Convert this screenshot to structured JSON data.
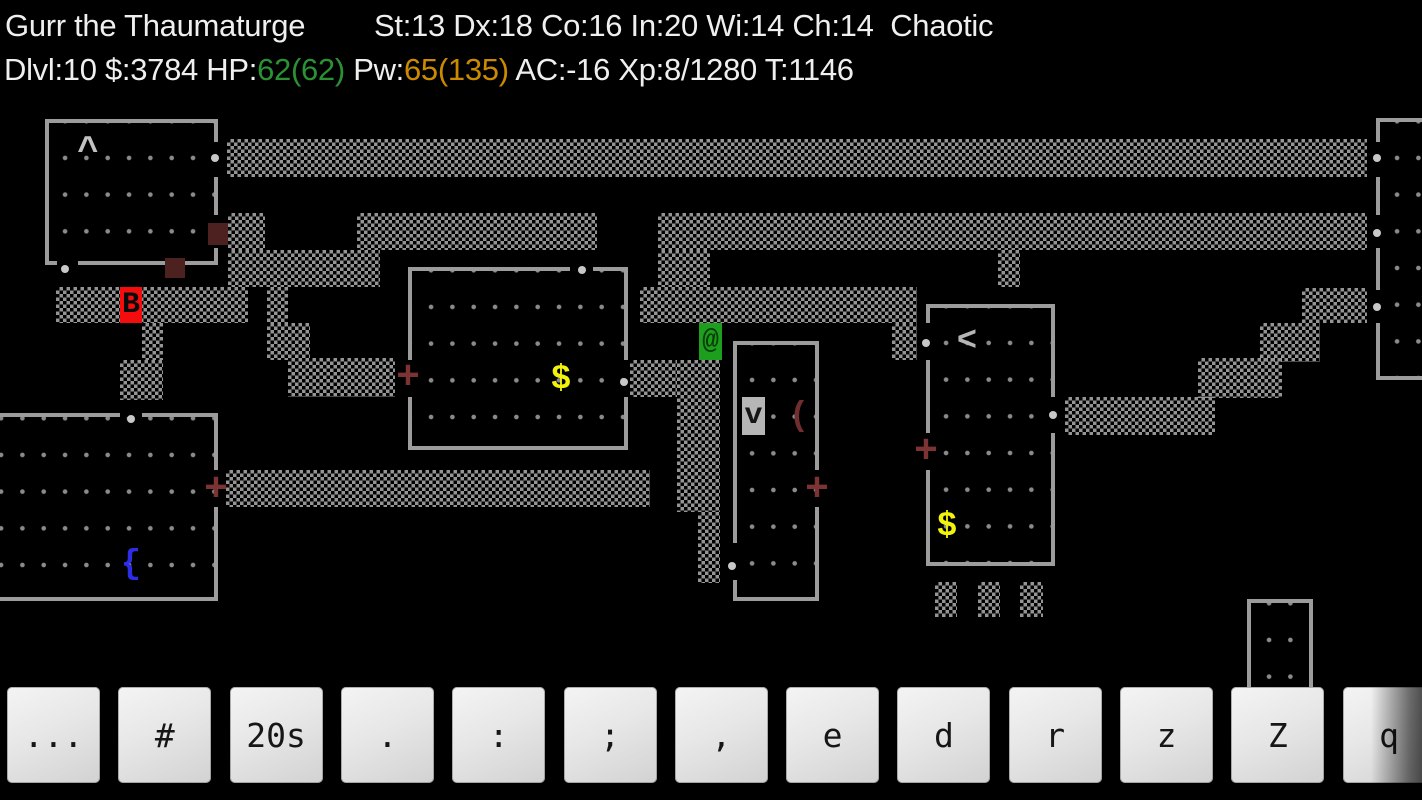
{
  "status": {
    "line1_left": "Gurr the Thaumaturge",
    "line1_right": "St:13 Dx:18 Co:16 In:20 Wi:14 Ch:14  Chaotic",
    "line2": [
      {
        "text": "Dlvl:10 $:3784 HP:",
        "color": "#efefef"
      },
      {
        "text": "62(62)",
        "color": "#2a9235"
      },
      {
        "text": " Pw:",
        "color": "#efefef"
      },
      {
        "text": "65(135)",
        "color": "#cc8a00"
      },
      {
        "text": " AC:-16 Xp:8/1280 T:1146",
        "color": "#efefef"
      }
    ]
  },
  "palette": {
    "wall": "#9c9c9c",
    "floor_dot": "#8b8b8b",
    "corridor_dot": "#949494",
    "doorway_dot": "#c8c8c8",
    "closed_door": "#4e2121"
  },
  "map": {
    "walls": [
      [
        45,
        119,
        173,
        4
      ],
      [
        45,
        119,
        4,
        146
      ],
      [
        214,
        119,
        4,
        23
      ],
      [
        214,
        177,
        4,
        38
      ],
      [
        214,
        248,
        4,
        17
      ],
      [
        45,
        261,
        12,
        4
      ],
      [
        78,
        261,
        87,
        4
      ],
      [
        184,
        261,
        34,
        4
      ],
      [
        408,
        267,
        162,
        4
      ],
      [
        593,
        267,
        35,
        4
      ],
      [
        408,
        267,
        4,
        93
      ],
      [
        408,
        397,
        4,
        53
      ],
      [
        624,
        267,
        4,
        93
      ],
      [
        624,
        397,
        4,
        53
      ],
      [
        408,
        446,
        220,
        4
      ],
      [
        733,
        341,
        86,
        4
      ],
      [
        733,
        341,
        4,
        202
      ],
      [
        733,
        580,
        4,
        21
      ],
      [
        815,
        341,
        4,
        129
      ],
      [
        815,
        507,
        4,
        94
      ],
      [
        733,
        597,
        86,
        4
      ],
      [
        926,
        304,
        129,
        4
      ],
      [
        926,
        304,
        4,
        19
      ],
      [
        926,
        360,
        4,
        73
      ],
      [
        926,
        470,
        4,
        96
      ],
      [
        1051,
        304,
        4,
        93
      ],
      [
        1051,
        433,
        4,
        133
      ],
      [
        926,
        562,
        129,
        4
      ],
      [
        0,
        413,
        120,
        4
      ],
      [
        142,
        413,
        76,
        4
      ],
      [
        214,
        413,
        4,
        57
      ],
      [
        214,
        507,
        4,
        94
      ],
      [
        0,
        597,
        218,
        4
      ],
      [
        1247,
        599,
        66,
        4
      ],
      [
        1247,
        599,
        4,
        99
      ],
      [
        1309,
        599,
        4,
        99
      ],
      [
        1376,
        118,
        46,
        4
      ],
      [
        1376,
        118,
        4,
        24
      ],
      [
        1376,
        177,
        4,
        38
      ],
      [
        1376,
        248,
        4,
        42
      ],
      [
        1376,
        323,
        4,
        57
      ],
      [
        1376,
        376,
        46,
        4
      ]
    ],
    "floors": [
      {
        "rect": [
          49,
          123,
          165,
          138
        ],
        "dot": [
          5.4,
          16.6
        ]
      },
      {
        "rect": [
          412,
          271,
          212,
          175
        ],
        "dot": [
          8.4,
          17.6
        ]
      },
      {
        "rect": [
          737,
          345,
          78,
          252
        ],
        "dot": [
          4.4,
          16.6
        ]
      },
      {
        "rect": [
          930,
          308,
          121,
          254
        ],
        "dot": [
          5.4,
          16.6
        ]
      },
      {
        "rect": [
          0,
          417,
          214,
          180
        ],
        "dot": [
          -9.6,
          19.6
        ]
      },
      {
        "rect": [
          1251,
          603,
          58,
          96
        ],
        "dot": [
          7.4,
          18.6
        ]
      },
      {
        "rect": [
          1380,
          122,
          42,
          254
        ],
        "dot": [
          6.4,
          17.6
        ]
      }
    ],
    "corridors": [
      [
        227,
        139,
        1140,
        38
      ],
      [
        228,
        213,
        37,
        37
      ],
      [
        228,
        250,
        152,
        37
      ],
      [
        357,
        213,
        240,
        37
      ],
      [
        658,
        213,
        709,
        37
      ],
      [
        658,
        250,
        52,
        37
      ],
      [
        998,
        250,
        22,
        37
      ],
      [
        56,
        287,
        192,
        36
      ],
      [
        142,
        323,
        21,
        37
      ],
      [
        120,
        360,
        43,
        40
      ],
      [
        267,
        287,
        21,
        36
      ],
      [
        267,
        323,
        43,
        37
      ],
      [
        288,
        358,
        107,
        39
      ],
      [
        640,
        287,
        277,
        36
      ],
      [
        892,
        323,
        25,
        37
      ],
      [
        630,
        360,
        47,
        37
      ],
      [
        677,
        360,
        43,
        152
      ],
      [
        698,
        512,
        22,
        71
      ],
      [
        226,
        470,
        424,
        37
      ],
      [
        1065,
        397,
        150,
        38
      ],
      [
        1198,
        358,
        84,
        40
      ],
      [
        1260,
        323,
        60,
        39
      ],
      [
        1302,
        288,
        65,
        35
      ],
      [
        935,
        582,
        22,
        35
      ],
      [
        978,
        582,
        22,
        35
      ],
      [
        1020,
        582,
        23,
        35
      ]
    ],
    "closed_doors": [
      [
        208,
        223,
        20,
        22
      ],
      [
        165,
        258,
        20,
        20
      ]
    ],
    "doorway_dots": [
      [
        215,
        158
      ],
      [
        65,
        269
      ],
      [
        582,
        270
      ],
      [
        624,
        382
      ],
      [
        732,
        566
      ],
      [
        131,
        419
      ],
      [
        926,
        343
      ],
      [
        1053,
        415
      ],
      [
        1377,
        158
      ],
      [
        1377,
        233
      ],
      [
        1377,
        307
      ]
    ],
    "glyphs": [
      {
        "name": "trap",
        "ch": "^",
        "box": [
          77,
          134,
          22,
          34
        ],
        "fg": "#c2c2c2",
        "size": 36,
        "inter": false
      },
      {
        "name": "stairs-up",
        "ch": "<",
        "box": [
          956,
          323,
          22,
          37
        ],
        "fg": "#b5b5b5",
        "size": 34,
        "inter": false
      },
      {
        "name": "gold-pile-1",
        "ch": "$",
        "box": [
          550,
          361,
          22,
          37
        ],
        "fg": "#f2f20c",
        "size": 34,
        "inter": false
      },
      {
        "name": "gold-pile-2",
        "ch": "$",
        "box": [
          936,
          508,
          22,
          37
        ],
        "fg": "#f2f20c",
        "size": 34,
        "inter": false
      },
      {
        "name": "fountain",
        "ch": "{",
        "box": [
          120,
          546,
          22,
          38
        ],
        "fg": "#2d2de6",
        "size": 34,
        "inter": false
      },
      {
        "name": "weapon-item",
        "ch": "(",
        "box": [
          788,
          398,
          22,
          37
        ],
        "fg": "#702e2e",
        "size": 34,
        "inter": false
      },
      {
        "name": "open-door-1",
        "ch": "+",
        "box": [
          396,
          359,
          24,
          38
        ],
        "fg": "#7b3333",
        "size": 40,
        "inter": true
      },
      {
        "name": "open-door-2",
        "ch": "+",
        "box": [
          805,
          471,
          24,
          38
        ],
        "fg": "#7b3333",
        "size": 40,
        "inter": true
      },
      {
        "name": "open-door-3",
        "ch": "+",
        "box": [
          914,
          433,
          24,
          38
        ],
        "fg": "#7b3333",
        "size": 40,
        "inter": true
      },
      {
        "name": "open-door-4",
        "ch": "+",
        "box": [
          204,
          471,
          24,
          38
        ],
        "fg": "#7b3333",
        "size": 40,
        "inter": true
      },
      {
        "name": "monster-bat",
        "ch": "B",
        "box": [
          120,
          287,
          22,
          36
        ],
        "fg": "#0a0a0a",
        "bg": "#f50d0d",
        "size": 30,
        "inter": true
      },
      {
        "name": "player",
        "ch": "@",
        "box": [
          699,
          323,
          23,
          37
        ],
        "fg": "#0a3d0a",
        "bg": "#1d9e1d",
        "size": 28,
        "inter": true
      },
      {
        "name": "creature-v",
        "ch": "v",
        "box": [
          742,
          397,
          23,
          38
        ],
        "fg": "#151515",
        "bg": "#b6b6b6",
        "size": 30,
        "inter": true
      }
    ]
  },
  "keyboard": {
    "keys": [
      "...",
      "#",
      "20s",
      ".",
      ":",
      ";",
      ",",
      "e",
      "d",
      "r",
      "z",
      "Z",
      "q"
    ]
  }
}
